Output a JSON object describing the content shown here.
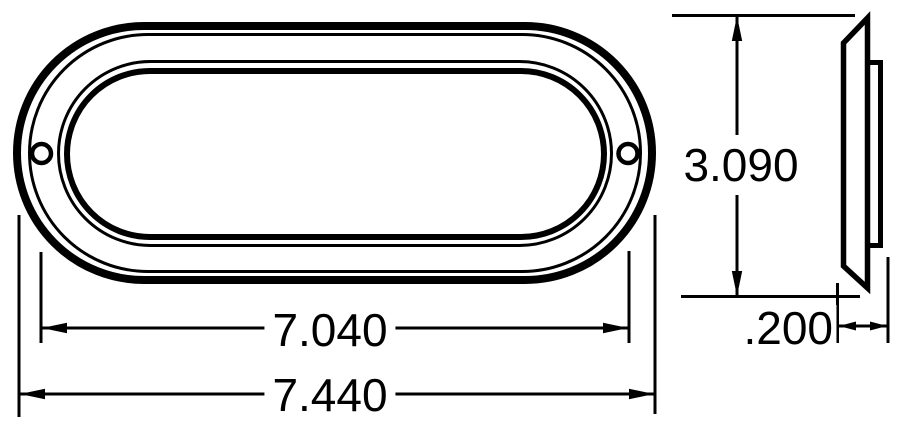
{
  "drawing": {
    "dimensions": {
      "height": "3.090",
      "inner_width": "7.040",
      "overall_width": "7.440",
      "depth": ".200"
    },
    "colors": {
      "line": "#000000",
      "background": "#ffffff"
    }
  }
}
